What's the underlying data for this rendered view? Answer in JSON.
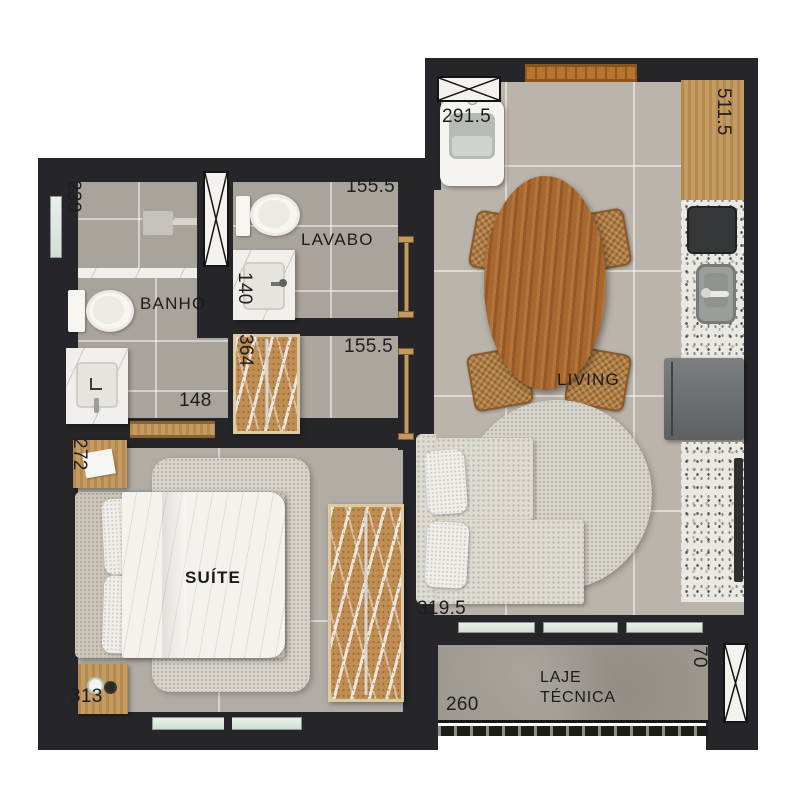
{
  "rooms": {
    "living": "LIVING",
    "suite": "SUÍTE",
    "banho": "BANHO",
    "lavabo": "LAVABO",
    "laje_line1": "LAJE",
    "laje_line2": "TÉCNICA"
  },
  "dimensions": {
    "tank": "291.5",
    "kitchen_counter": "511.5",
    "shower": "230",
    "lavabo_width": "155.5",
    "lavabo_sink": "140",
    "banho_vanity": "148",
    "hall_wardrobe": "364",
    "hall_width": "155.5",
    "nightstand_top": "272",
    "sofa": "319.5",
    "nightstand_bottom": "313",
    "laje_width": "260",
    "laje_depth": "70"
  },
  "colors": {
    "wall": "#26262a",
    "floor_living": "#bab4ab",
    "floor_bath": "#a8a39b",
    "floor_suite": "#b1aca4",
    "wood_counter": "#c49b61",
    "table_wood": "#a8672e",
    "terrazzo": "#eae8e2",
    "marble": "#f1efeb",
    "rug": "#d7d4cb",
    "window_glass": "#cfe0d2",
    "concrete": "#9d9990"
  }
}
